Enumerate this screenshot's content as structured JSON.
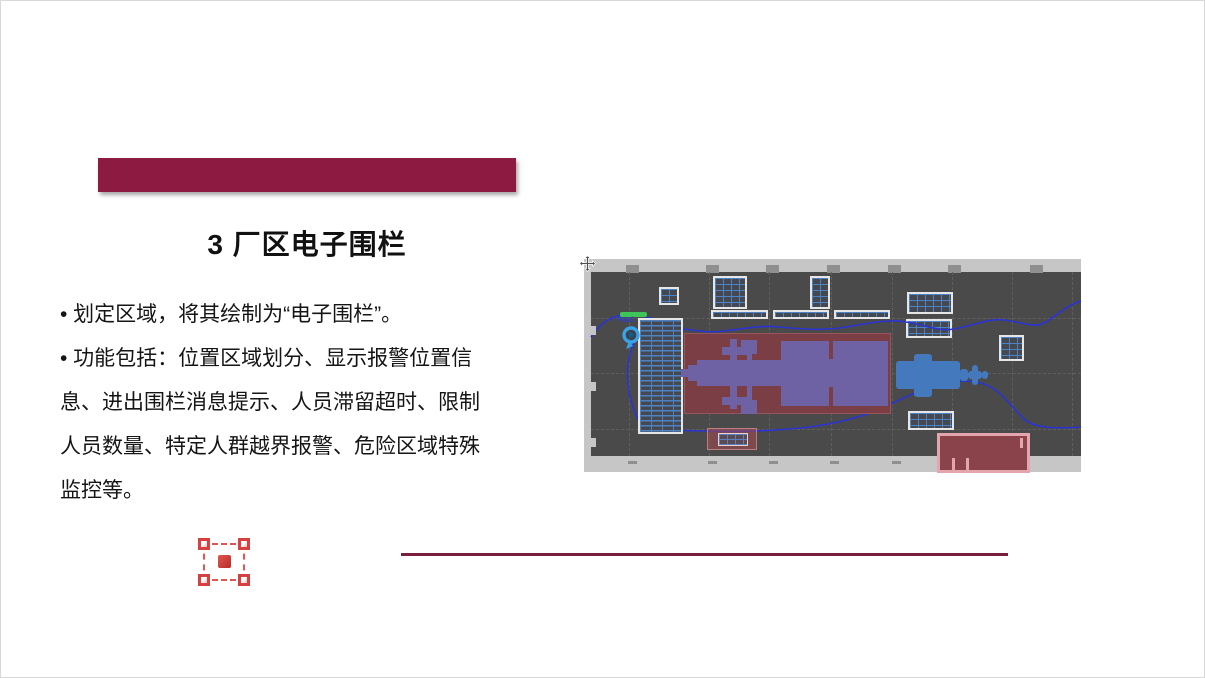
{
  "slide": {
    "title": "3 厂区电子围栏",
    "bullets": [
      "• 划定区域，将其绘制为“电子围栏”。",
      "• 功能包括：位置区域划分、显示报警位置信息、进出围栏消息提示、人员滞留超时、限制人员数量、特定人群越界报警、危险区域特殊监控等。"
    ]
  },
  "map": {
    "fence_label": "电子围栏",
    "pin_label": "F62d"
  },
  "colors": {
    "accent": "#8d1b41",
    "divider": "#7a1e3d",
    "map-bg": "#4a4a4b",
    "map-frame": "#c6c6c6",
    "grid-blue": "#4d83c4",
    "fence-red": "#7b3e45",
    "machine-purple": "#6e62a4",
    "machine-blue": "#4579bd",
    "route-blue": "#2b34d2",
    "pin-blue": "#38a3e8",
    "marker-green": "#3fc45c",
    "selection-red": "#d64040",
    "pink-zone": "#e3a6ad"
  }
}
